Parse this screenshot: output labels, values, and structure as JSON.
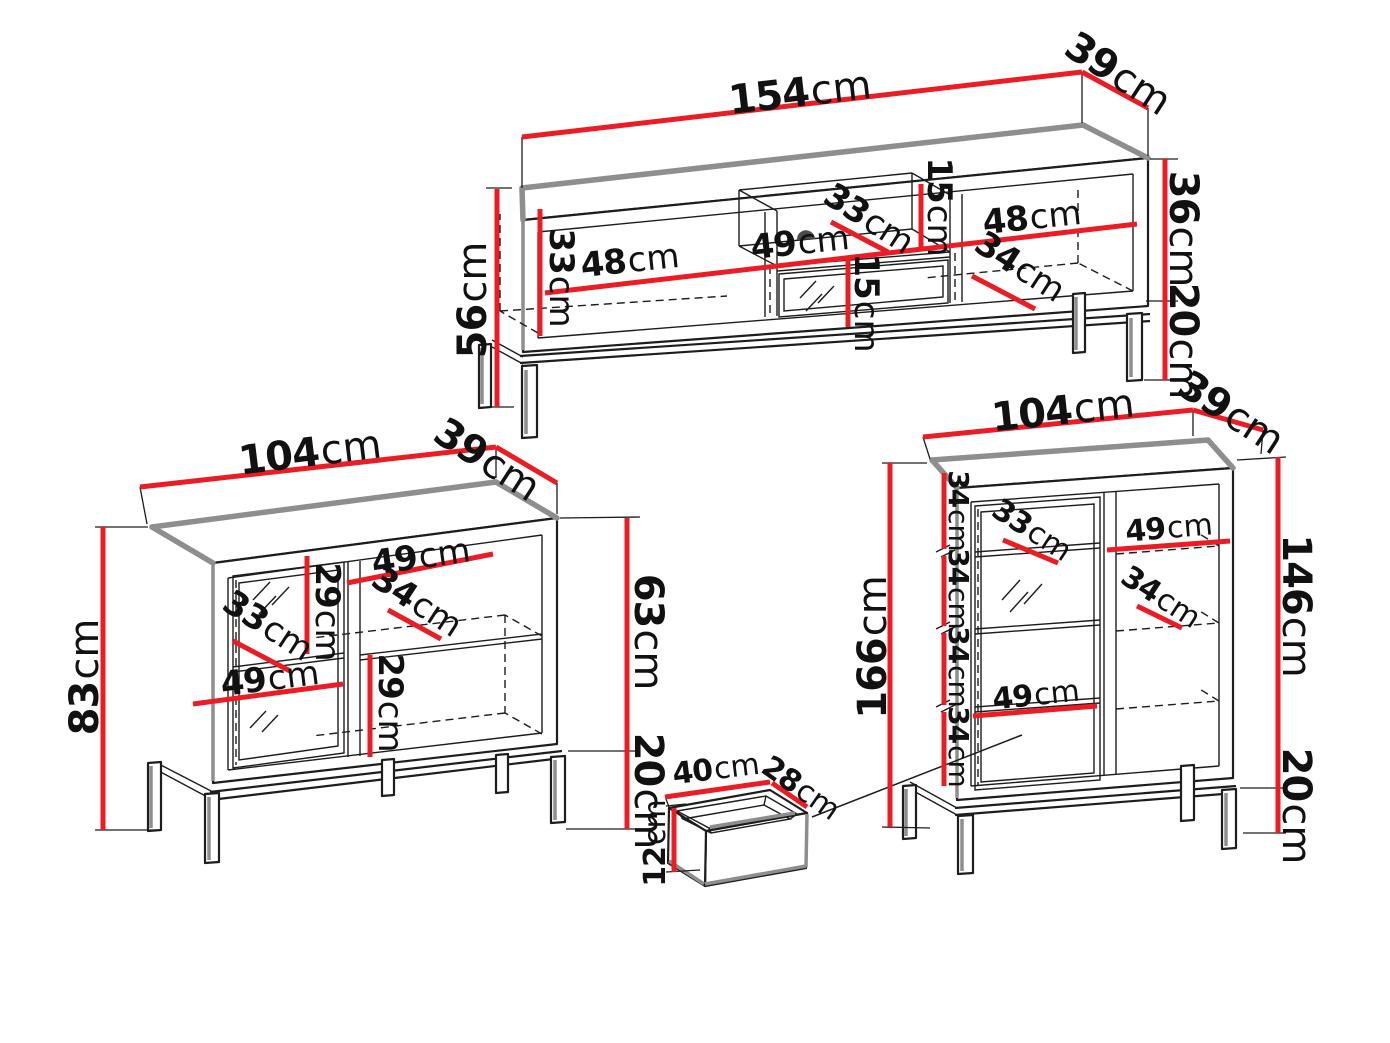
{
  "diagram": {
    "type": "furniture-dimension-drawing",
    "unit": "cm",
    "colors": {
      "dimension_line": "#ec1c24",
      "outline": "#1d1d1b",
      "shadow": "#8e8e8e",
      "background": "#ffffff"
    },
    "tv_stand": {
      "width": {
        "v": "154",
        "u": "cm"
      },
      "depth": {
        "v": "39",
        "u": "cm"
      },
      "total_height": {
        "v": "56",
        "u": "cm"
      },
      "interior_height": {
        "v": "33",
        "u": "cm"
      },
      "left_compartment_width": {
        "v": "48",
        "u": "cm"
      },
      "middle_diagonal": {
        "v": "33",
        "u": "cm"
      },
      "middle_compartment_width": {
        "v": "49",
        "u": "cm"
      },
      "niche_height": {
        "v": "15",
        "u": "cm"
      },
      "lower_compartment_height": {
        "v": "15",
        "u": "cm"
      },
      "right_compartment_width": {
        "v": "48",
        "u": "cm"
      },
      "right_diagonal": {
        "v": "34",
        "u": "cm"
      },
      "body_height": {
        "v": "36",
        "u": "cm"
      },
      "leg_height": {
        "v": "20",
        "u": "cm"
      }
    },
    "sideboard": {
      "width": {
        "v": "104",
        "u": "cm"
      },
      "depth": {
        "v": "39",
        "u": "cm"
      },
      "total_height": {
        "v": "83",
        "u": "cm"
      },
      "body_height": {
        "v": "63",
        "u": "cm"
      },
      "leg_height": {
        "v": "20",
        "u": "cm"
      },
      "right_compartment_width": {
        "v": "49",
        "u": "cm"
      },
      "upper_compartment_height": {
        "v": "29",
        "u": "cm"
      },
      "door_diagonal": {
        "v": "33",
        "u": "cm"
      },
      "right_diagonal": {
        "v": "34",
        "u": "cm"
      },
      "door_compartment_width": {
        "v": "49",
        "u": "cm"
      },
      "lower_compartment_height": {
        "v": "29",
        "u": "cm"
      }
    },
    "display_cabinet": {
      "width": {
        "v": "104",
        "u": "cm"
      },
      "depth": {
        "v": "39",
        "u": "cm"
      },
      "total_height": {
        "v": "166",
        "u": "cm"
      },
      "body_height": {
        "v": "146",
        "u": "cm"
      },
      "leg_height": {
        "v": "20",
        "u": "cm"
      },
      "shelf_spacings": [
        {
          "v": "34",
          "u": "cm"
        },
        {
          "v": "34",
          "u": "cm"
        },
        {
          "v": "34",
          "u": "cm"
        },
        {
          "v": "34",
          "u": "cm"
        }
      ],
      "door_diagonal": {
        "v": "33",
        "u": "cm"
      },
      "right_compartment_width": {
        "v": "49",
        "u": "cm"
      },
      "right_diagonal": {
        "v": "34",
        "u": "cm"
      },
      "door_compartment_width": {
        "v": "49",
        "u": "cm"
      }
    },
    "drawer": {
      "width": {
        "v": "40",
        "u": "cm"
      },
      "depth": {
        "v": "28",
        "u": "cm"
      },
      "height": {
        "v": "12",
        "u": "cm"
      }
    }
  }
}
